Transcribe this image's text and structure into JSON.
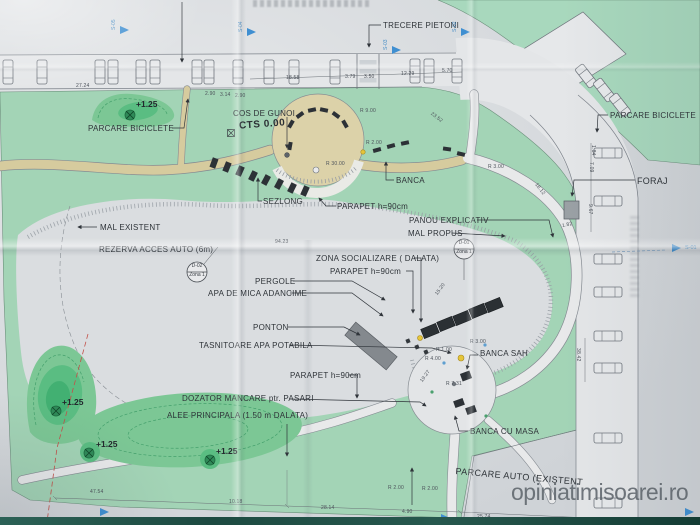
{
  "watermark": "opiniatimisoarei.ro",
  "ground_level": "CTS 0.00",
  "annotations": {
    "trecere_pietoni": "TRECERE PIETONI",
    "parcare_biciclete_left": "PARCARE BICICLETE",
    "cos_de_gunoi": "COS DE GUNOI",
    "banca": "BANCA",
    "sezlong": "SEZLONG",
    "parapet_1": "PARAPET h=90cm",
    "panou_explicativ": "PANOU EXPLICATIV",
    "mal_propus": "MAL PROPUS",
    "mal_existent": "MAL EXISTENT",
    "rezerva_acces_auto": "REZERVA ACCES AUTO (6m)",
    "zona_socializare": "ZONA SOCIALIZARE ( DALATA)",
    "parapet_2": "PARAPET h=90cm",
    "pergole": "PERGOLE",
    "apa_de_mica_adancime": "APA DE MICA ADANCIME",
    "ponton": "PONTON",
    "tasnitoare": "TASNITOARE APA POTABILA",
    "parapet_3": "PARAPET h=90cm",
    "dozator": "DOZATOR MANCARE ptr. PASARI",
    "alee_principala": "ALEE PRINCIPALA (1.50 m DALATA)",
    "banca_sah": "BANCA SAH",
    "banca_cu_masa": "BANCA CU MASA",
    "parcare_auto_existent": "PARCARE AUTO (EXISTENT",
    "parcare_biciclete_right": "PARCARE BICICLETE",
    "foraj": "FORAJ"
  },
  "spot_levels": {
    "a": "+1.25",
    "b": "+1.25",
    "c": "+1.25",
    "d": "+1.25"
  },
  "flags": {
    "s01": "S-01",
    "s02": "S-02",
    "s03": "S-03",
    "s04": "S-04",
    "s05": "S-05"
  },
  "details": {
    "d01": {
      "code": "D-01",
      "zone": "Zona 1"
    },
    "d02": {
      "code": "D-02",
      "zone": "Zona 1"
    }
  },
  "dims": {
    "d2724": "27.24",
    "d1858": "18.58",
    "d379": "3.79",
    "d350": "3.50",
    "d1229": "12.29",
    "d570": "5.70",
    "d290a": "2.90",
    "d314": "3.14",
    "d290b": "2.90",
    "d9423": "94.23",
    "d3842": "38.42",
    "d1812": "18.12",
    "d2352": "23.52",
    "d1520": "15.20",
    "d1927": "19.27",
    "d4754": "47.54",
    "d1018": "10.18",
    "d2814": "28.14",
    "d490": "4.90",
    "d2574": "25.74",
    "d967": "9.67",
    "d709": "7.09",
    "d184": "1.84",
    "d182": "1.82",
    "r900": "R 9.00",
    "r3000": "R 30.00",
    "r200a": "R 2.00",
    "r200b": "R 2.00",
    "r200c": "R 2.00",
    "r300a": "R 3.00",
    "r300b": "R 3.00",
    "r100": "R 1.00",
    "r400": "R 4.00",
    "r731": "R 7.31"
  },
  "colors": {
    "park": "#a3d4b6",
    "mound": "#7cc795",
    "path_beige": "#d6cb9e",
    "plaza_tan": "#dcd2a9",
    "flag_blue": "#3f8fd1",
    "paper": "#dadde0",
    "structure_dark": "#2c3136",
    "boundary_red": "#c2514a",
    "accent_yellow": "#e5c53a"
  }
}
